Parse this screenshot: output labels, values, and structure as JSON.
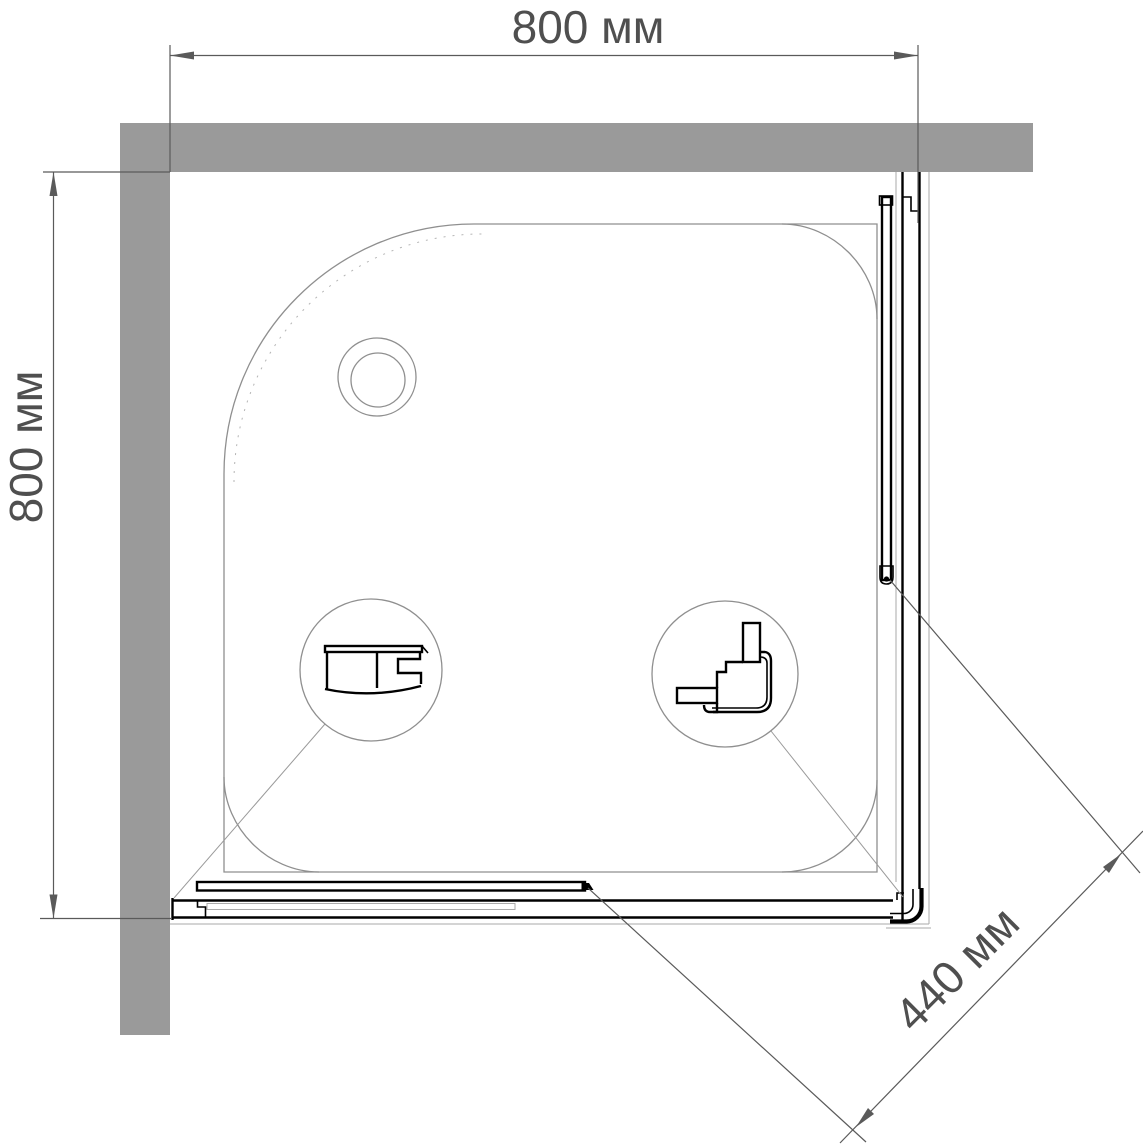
{
  "drawing": {
    "type": "shower-enclosure-top-view-plan",
    "dimensions": {
      "width_top": "800 мм",
      "depth_left": "800 мм",
      "entry_diagonal": "440 мм"
    },
    "colors": {
      "wall": "#9a9a9a",
      "profile": "#000000",
      "tray_line": "#8f8f8f",
      "dimension_text": "#4f4f4f",
      "background": "#ffffff"
    }
  }
}
